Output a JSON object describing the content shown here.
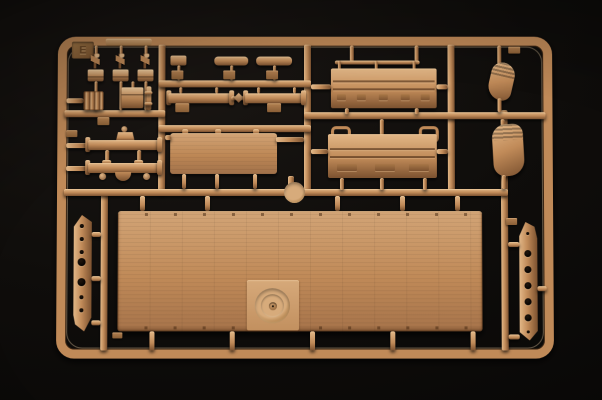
{
  "photo": {
    "subject": "Injection-molded tan plastic model kit sprue photographed on a black backdrop",
    "sprue_label": "E"
  },
  "colors": {
    "backdrop": "#0d0b09",
    "plastic_base": "#c08a58",
    "plastic_hi": "#e2b787",
    "plastic_lo": "#7c5230",
    "plastic_deep": "#4a2d16",
    "tab_dark": "#96693d"
  },
  "parts_inventory": [
    {
      "label": "shift-levers",
      "count": 3
    },
    {
      "label": "grille-plate",
      "count": 1
    },
    {
      "label": "stowage-box",
      "count": 1
    },
    {
      "label": "small-cylinder",
      "count": 1
    },
    {
      "label": "detail-bars",
      "count": 3
    },
    {
      "label": "linked-axle-rods",
      "count": 1
    },
    {
      "label": "axle-assemblies",
      "count": 2
    },
    {
      "label": "small-roof-panel",
      "count": 1
    },
    {
      "label": "round-hatch-cap",
      "count": 1
    },
    {
      "label": "cargo-side-boards",
      "count": 2
    },
    {
      "label": "fenders",
      "count": 2
    },
    {
      "label": "perforated-side-rails",
      "count": 2
    },
    {
      "label": "cargo-bed-floor-panel",
      "count": 1
    }
  ]
}
